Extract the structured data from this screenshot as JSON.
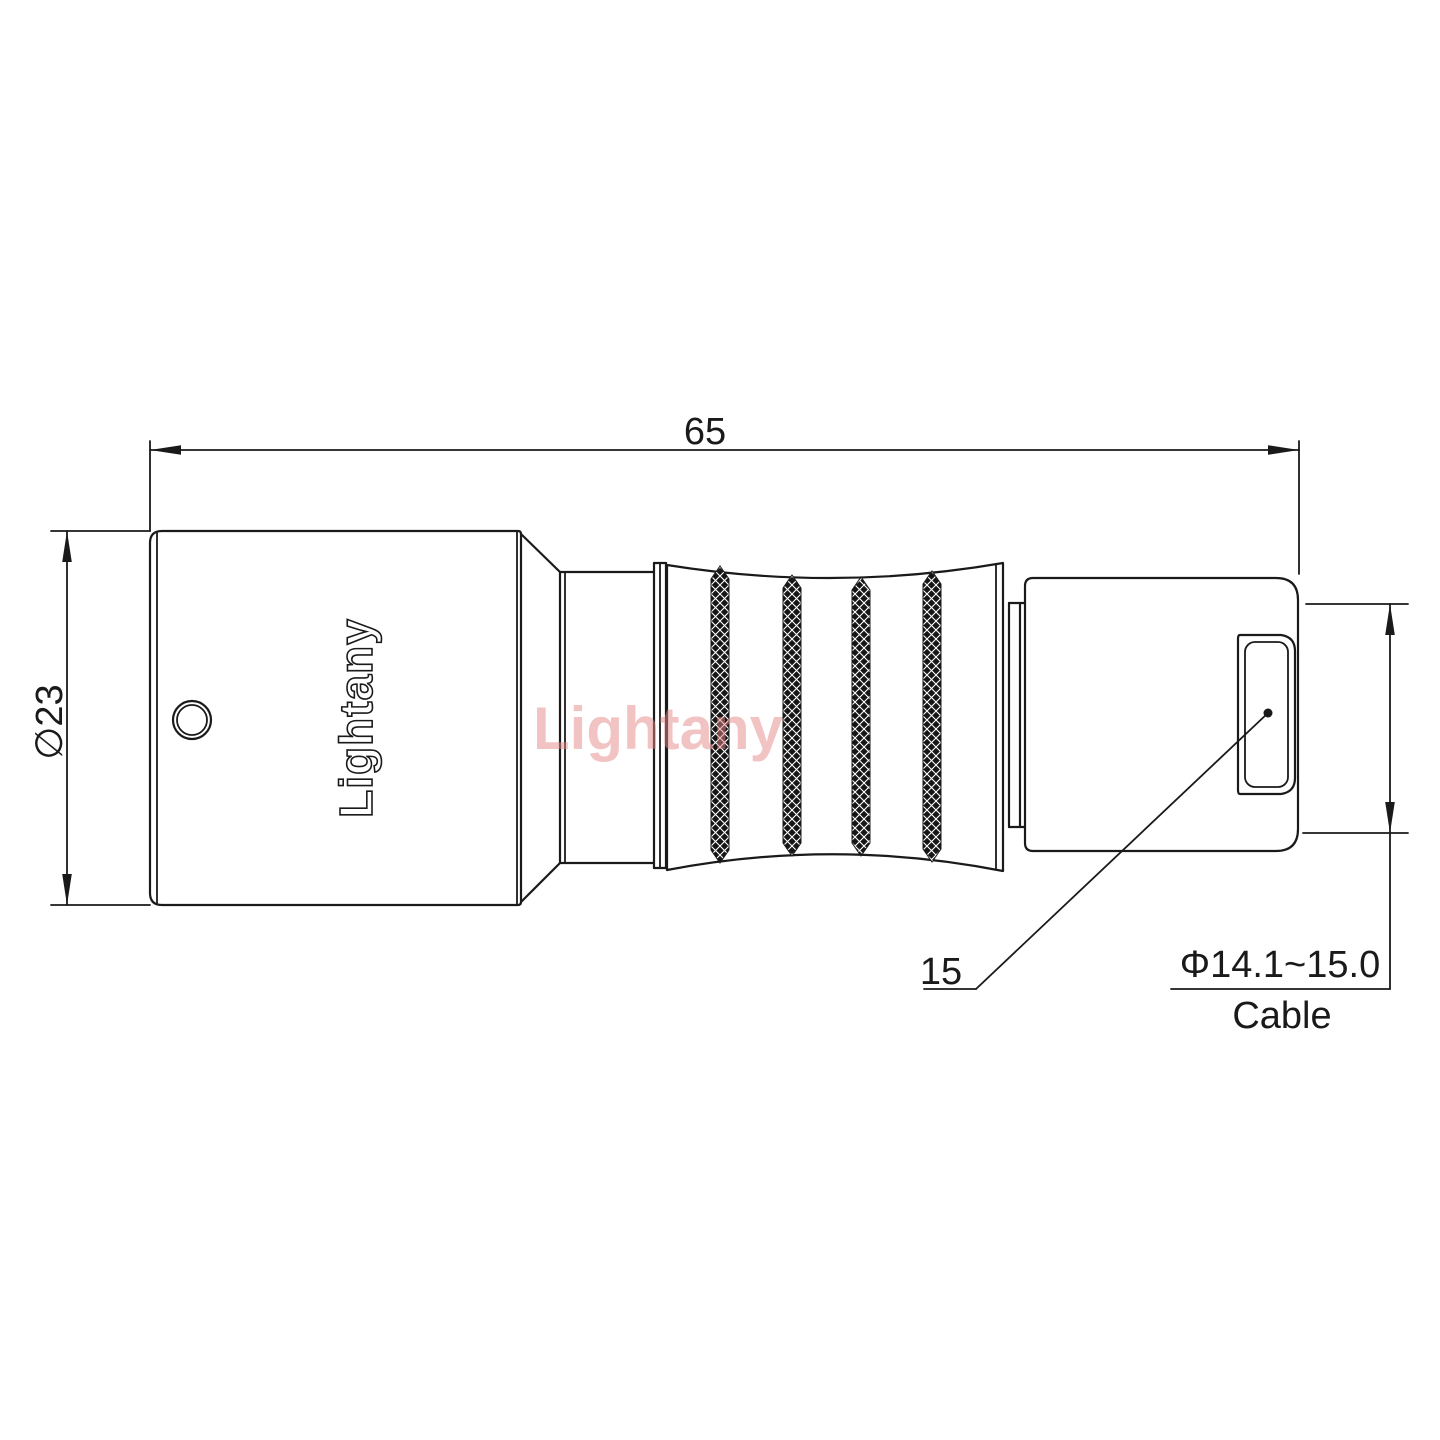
{
  "drawing": {
    "branding": {
      "watermark": "Lightany",
      "logo_engraving": "Lightany"
    },
    "dimensions": {
      "overall_length": "65",
      "body_diameter": "∅23",
      "nut_size": "15",
      "cable_diameter_range": "Φ14.1~15.0",
      "cable_label": "Cable"
    },
    "colors": {
      "line": "#1a1a1a",
      "watermark": "#e78989",
      "background": "#ffffff"
    }
  }
}
